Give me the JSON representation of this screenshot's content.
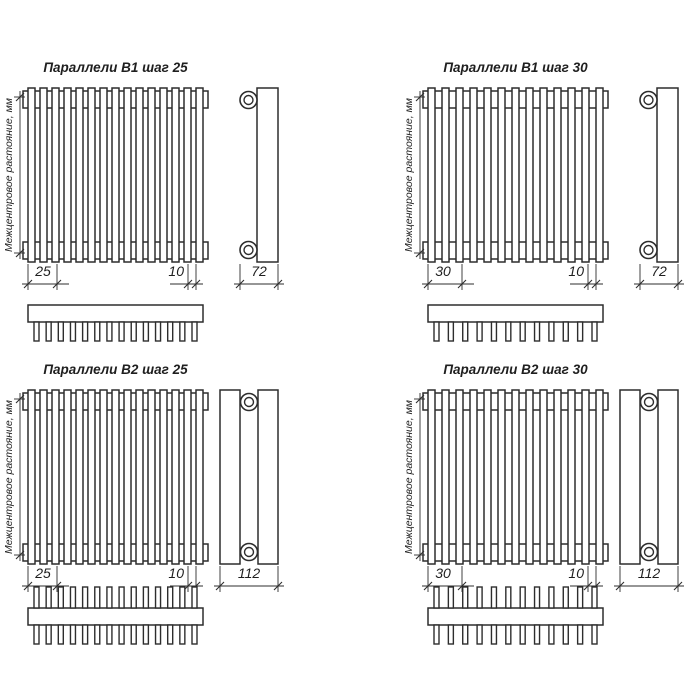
{
  "colors": {
    "background": "#ffffff",
    "line": "#2d2d2d",
    "text": "#1f1f1f"
  },
  "drawings": [
    {
      "title": "Параллели В1 шаг 25",
      "vertical_label": "Межцентровое растояние, мм",
      "pitch_dim": "25",
      "tube_dim": "10",
      "depth_dim": "72",
      "type": "B1",
      "rows": 1,
      "front_tubes": 15,
      "top_teeth": 14
    },
    {
      "title": "Параллели В1 шаг 30",
      "vertical_label": "Межцентровое растояние, мм",
      "pitch_dim": "30",
      "tube_dim": "10",
      "depth_dim": "72",
      "type": "B1",
      "rows": 1,
      "front_tubes": 13,
      "top_teeth": 12
    },
    {
      "title": "Параллели В2 шаг 25",
      "vertical_label": "Межцентровое растояние, мм",
      "pitch_dim": "25",
      "tube_dim": "10",
      "depth_dim": "112",
      "type": "B2",
      "rows": 2,
      "front_tubes": 15,
      "top_teeth": 14
    },
    {
      "title": "Параллели В2 шаг 30",
      "vertical_label": "Межцентровое растояние, мм",
      "pitch_dim": "30",
      "tube_dim": "10",
      "depth_dim": "112",
      "type": "B2",
      "rows": 2,
      "front_tubes": 13,
      "top_teeth": 12
    }
  ]
}
